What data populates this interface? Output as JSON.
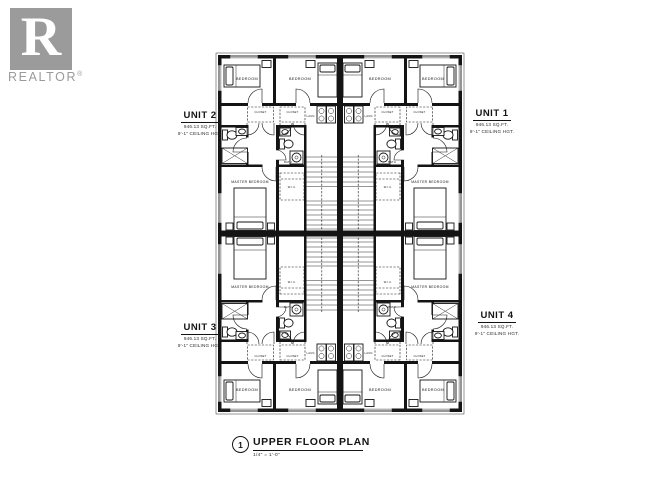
{
  "logo": {
    "letter": "R",
    "wordmark": "REALTOR",
    "registered": "®",
    "color": "#9b9b9b"
  },
  "units": {
    "unit1": {
      "name": "UNIT 1",
      "area": "946.13 SQ.FT.",
      "ceiling": "9'-1\" CEILING HGT."
    },
    "unit2": {
      "name": "UNIT 2",
      "area": "946.13 SQ.FT.",
      "ceiling": "9'-1\" CEILING HGT."
    },
    "unit3": {
      "name": "UNIT 3",
      "area": "946.13 SQ.FT.",
      "ceiling": "9'-1\" CEILING HGT."
    },
    "unit4": {
      "name": "UNIT 4",
      "area": "946.13 SQ.FT.",
      "ceiling": "9'-1\" CEILING HGT."
    }
  },
  "rooms": {
    "bedroom": "BEDROOM",
    "master": "MASTER BEDROOM",
    "closet": "CLOSET",
    "laundry": "LAUN.",
    "bath": "BATH",
    "wic": "W.I.C."
  },
  "title_block": {
    "number": "1",
    "title": "UPPER FLOOR PLAN",
    "scale": "1/4\" = 1'-0\""
  },
  "colors": {
    "ink": "#141414",
    "logo_gray": "#9b9b9b",
    "paper": "#ffffff"
  }
}
